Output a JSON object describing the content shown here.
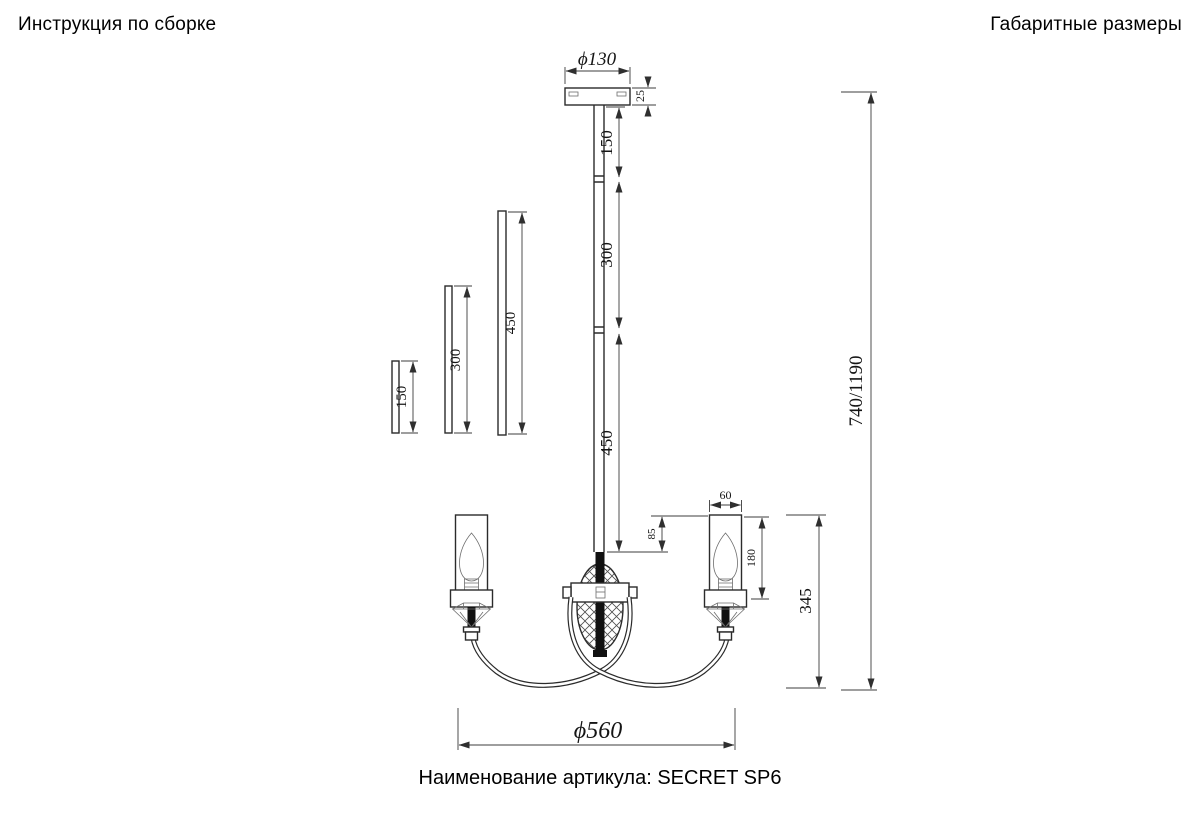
{
  "header": {
    "left_title": "Инструкция по сборке",
    "right_title": "Габаритные размеры"
  },
  "footer": {
    "article_label": "Наименование артикула: SECRET SP6"
  },
  "drawing": {
    "article": "SECRET SP6",
    "dimensions": {
      "canopy_diameter": "ϕ130",
      "canopy_thickness": "25",
      "stem_segment_1": "150",
      "stem_segment_2": "300",
      "stem_segment_3": "450",
      "center_drop": "85",
      "shade_width": "60",
      "shade_height": "180",
      "fixture_height": "345",
      "overall_height": "740/1190",
      "overall_diameter": "ϕ560",
      "spare_rods": {
        "short": "150",
        "medium": "300",
        "long": "450"
      }
    }
  }
}
